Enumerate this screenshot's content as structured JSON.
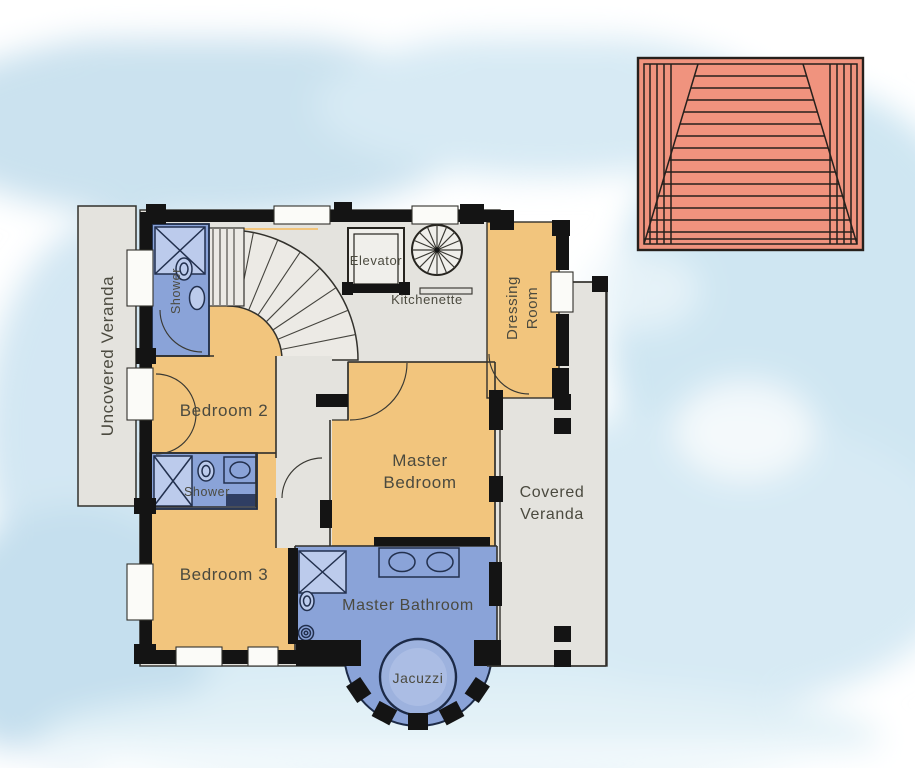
{
  "scene": {
    "kind": "watercolor architectural floor plan",
    "floor": "upper floor with bedrooms, bathrooms, verandas and roof detail"
  },
  "colors": {
    "background_wash": "#cfe4ef",
    "room_fill": "#f2c57d",
    "wet_room_fill": "#8aa3d8",
    "veranda_fill": "#e4e3de",
    "wall": "#141414",
    "roof_fill": "#f0937e",
    "label_text": "#4b4a3f",
    "jacuzzi_fill": "#9db2de"
  },
  "rooms": {
    "uncovered_veranda": {
      "label": "Uncovered Veranda"
    },
    "shower_top": {
      "label": "Shower"
    },
    "elevator": {
      "label": "Elevator"
    },
    "kitchenette": {
      "label": "Kitchenette"
    },
    "dressing_room": {
      "label": "Dressing Room",
      "label_lines": [
        "Dressing",
        "Room"
      ]
    },
    "bedroom_2": {
      "label": "Bedroom 2"
    },
    "master_bedroom": {
      "label": "Master Bedroom",
      "label_lines": [
        "Master",
        "Bedroom"
      ]
    },
    "covered_veranda": {
      "label": "Covered Veranda",
      "label_lines": [
        "Covered",
        "Veranda"
      ]
    },
    "shower_mid": {
      "label": "Shower"
    },
    "bedroom_3": {
      "label": "Bedroom 3"
    },
    "master_bathroom": {
      "label": "Master Bathroom"
    },
    "jacuzzi": {
      "label": "Jacuzzi"
    }
  },
  "icons": {
    "curved_staircase": "curved-staircase-icon",
    "spiral_staircase": "spiral-staircase-icon",
    "shower_stall": "shower-stall-icon",
    "toilet": "toilet-icon",
    "sink": "sink-icon",
    "double_sink": "double-sink-icon",
    "bidet": "bidet-icon",
    "jacuzzi_tub": "jacuzzi-tub-icon",
    "door_swing": "door-swing-icon",
    "window": "window-icon",
    "column": "column-icon",
    "roof": "hip-roof-icon"
  }
}
